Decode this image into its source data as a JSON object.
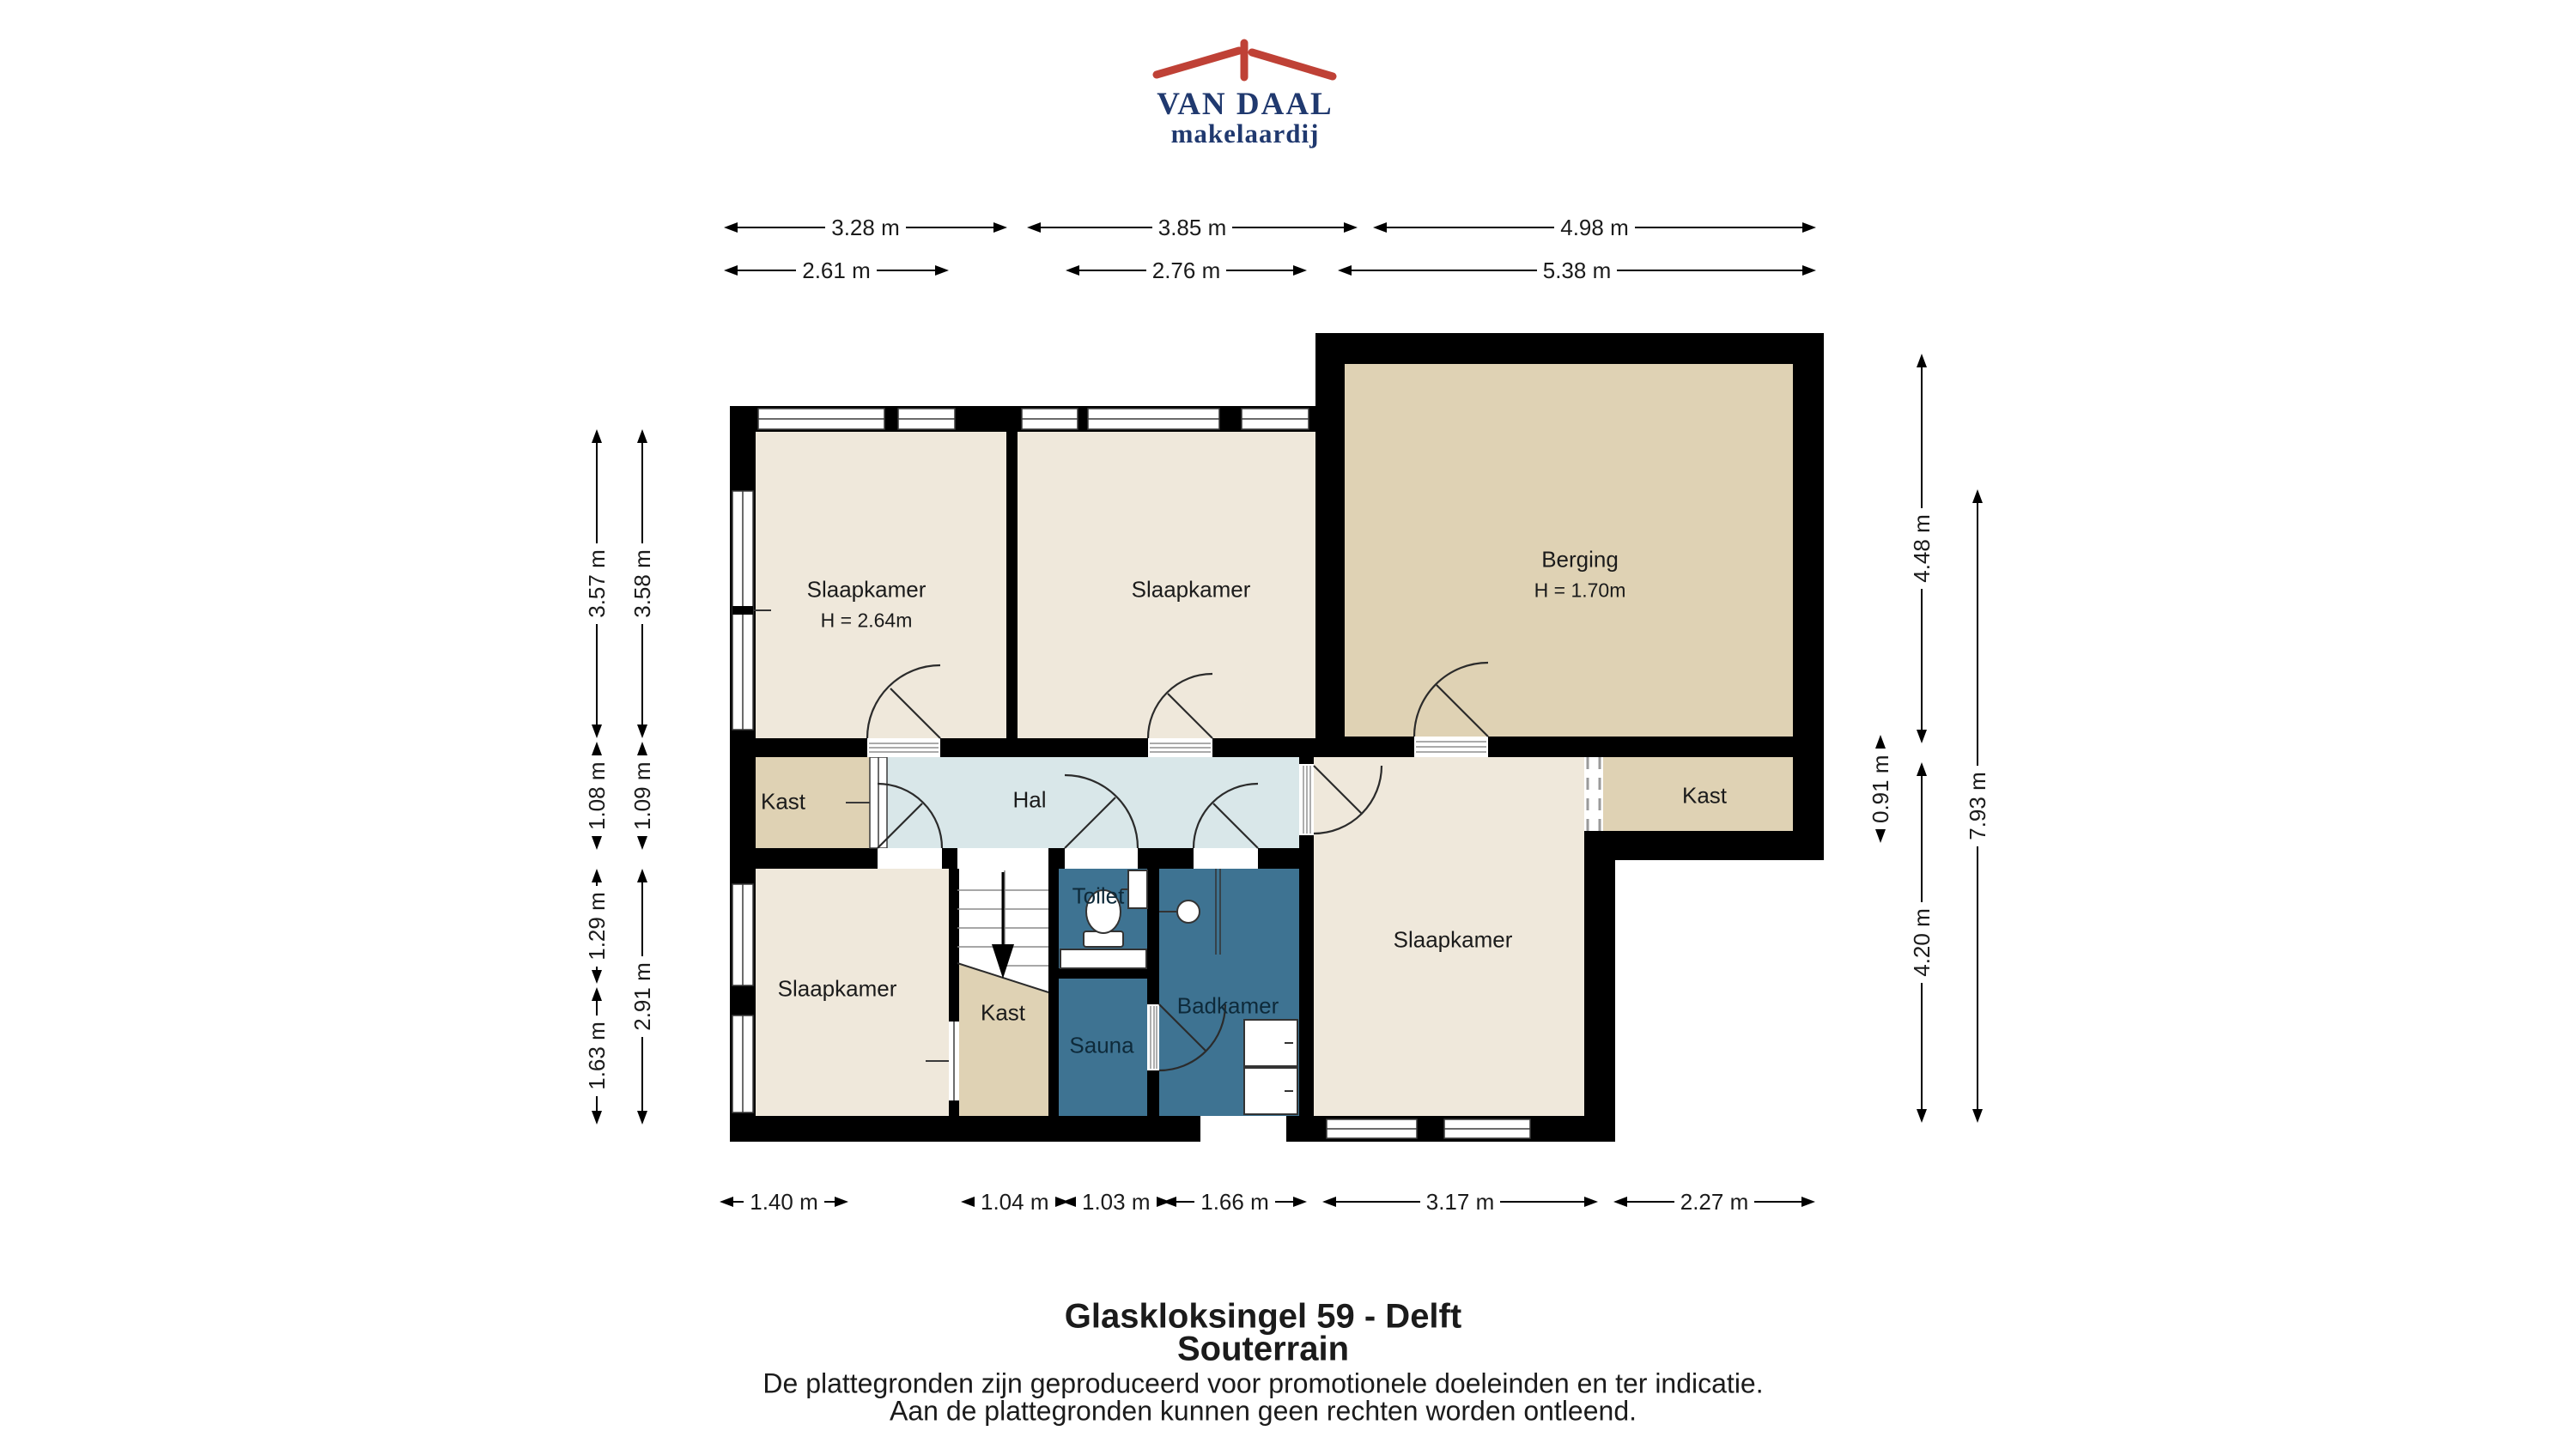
{
  "logo": {
    "name": "VAN DAAL",
    "tagline": "makelaardij"
  },
  "rooms": {
    "slaapkamer_top_left": {
      "label": "Slaapkamer",
      "height": "H = 2.64m"
    },
    "slaapkamer_top_middle": {
      "label": "Slaapkamer"
    },
    "berging": {
      "label": "Berging",
      "height": "H = 1.70m"
    },
    "hal": {
      "label": "Hal"
    },
    "kast_left": {
      "label": "Kast"
    },
    "kast_middle": {
      "label": "Kast"
    },
    "kast_right": {
      "label": "Kast"
    },
    "slaapkamer_bottom_left": {
      "label": "Slaapkamer"
    },
    "slaapkamer_right": {
      "label": "Slaapkamer"
    },
    "toilet": {
      "label": "Toilet"
    },
    "sauna": {
      "label": "Sauna"
    },
    "badkamer": {
      "label": "Badkamer"
    }
  },
  "dims": {
    "top_row_1": [
      "3.28 m",
      "3.85 m",
      "4.98 m"
    ],
    "top_row_2": [
      "2.61 m",
      "2.76 m",
      "5.38 m"
    ],
    "bottom_row": [
      "1.40 m",
      "1.04 m",
      "1.03 m",
      "1.66 m",
      "3.17 m",
      "2.27 m"
    ],
    "left_col_outer": [
      "3.57 m",
      "1.08 m",
      "1.29 m",
      "1.63 m"
    ],
    "left_col_inner": [
      "3.58 m",
      "1.09 m",
      "2.91 m"
    ],
    "right_col_inner": [
      "4.48 m",
      "0.91 m",
      "4.20 m"
    ],
    "right_col_outer": [
      "7.93 m"
    ]
  },
  "footer": {
    "address": "Glaskloksingel 59 - Delft",
    "floor": "Souterrain",
    "disclaimer_line1": "De plattegronden zijn geproduceerd voor promotionele doeleinden en ter indicatie.",
    "disclaimer_line2": "Aan de plattegronden kunnen geen rechten worden ontleend."
  },
  "colors": {
    "logo_blue": "#20396f",
    "logo_red": "#bf4136",
    "wall": "#000000",
    "room_cream": "#efe8db",
    "room_tan": "#dfd2b4",
    "hall_blue": "#d9e7e9",
    "wet_room_blue": "#3e7392"
  }
}
